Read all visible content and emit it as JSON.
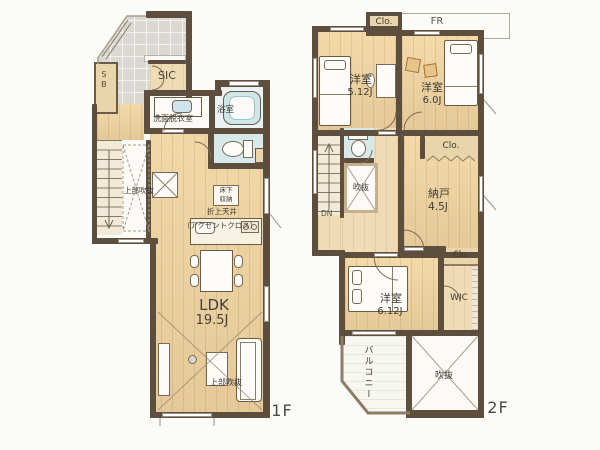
{
  "palette": {
    "wall": "#5d4e3d",
    "wood_floor": "#ecd5a8",
    "entry_tile": "#d9d8d2",
    "wet_area": "#d8e9ec",
    "bathtub": "#cde6e8",
    "closet_fill": "#ead5ab",
    "label_text": "#3e3a33"
  },
  "f1": {
    "floor_label": "1F",
    "sb": "SB",
    "sic": "SIC",
    "washroom": "洗面脱衣室",
    "bath": "浴室",
    "upper_void_stairs": "上部吹抜",
    "floor_storage_line1": "床下",
    "floor_storage_line2": "収納",
    "ceiling_line1": "折上天井",
    "ceiling_line2": "（アクセントクロス）",
    "ldk_name": "LDK",
    "ldk_size": "19.5J",
    "upper_void_living": "上部吹抜"
  },
  "f2": {
    "floor_label": "2F",
    "closet_top": "Clo.",
    "fr": "FR",
    "bedroom1_name": "洋室",
    "bedroom1_size": "5.12J",
    "bedroom2_name": "洋室",
    "bedroom2_size": "6.0J",
    "dn": "DN",
    "void_small": "吹抜",
    "closet_mid": "Clo.",
    "storage_name": "納戸",
    "storage_size": "4.5J",
    "bedroom3_name": "洋室",
    "bedroom3_size": "6.12J",
    "closet_bottom": "Clo.",
    "wic": "WIC",
    "balcony": "バルコニー",
    "void_large": "吹抜"
  }
}
